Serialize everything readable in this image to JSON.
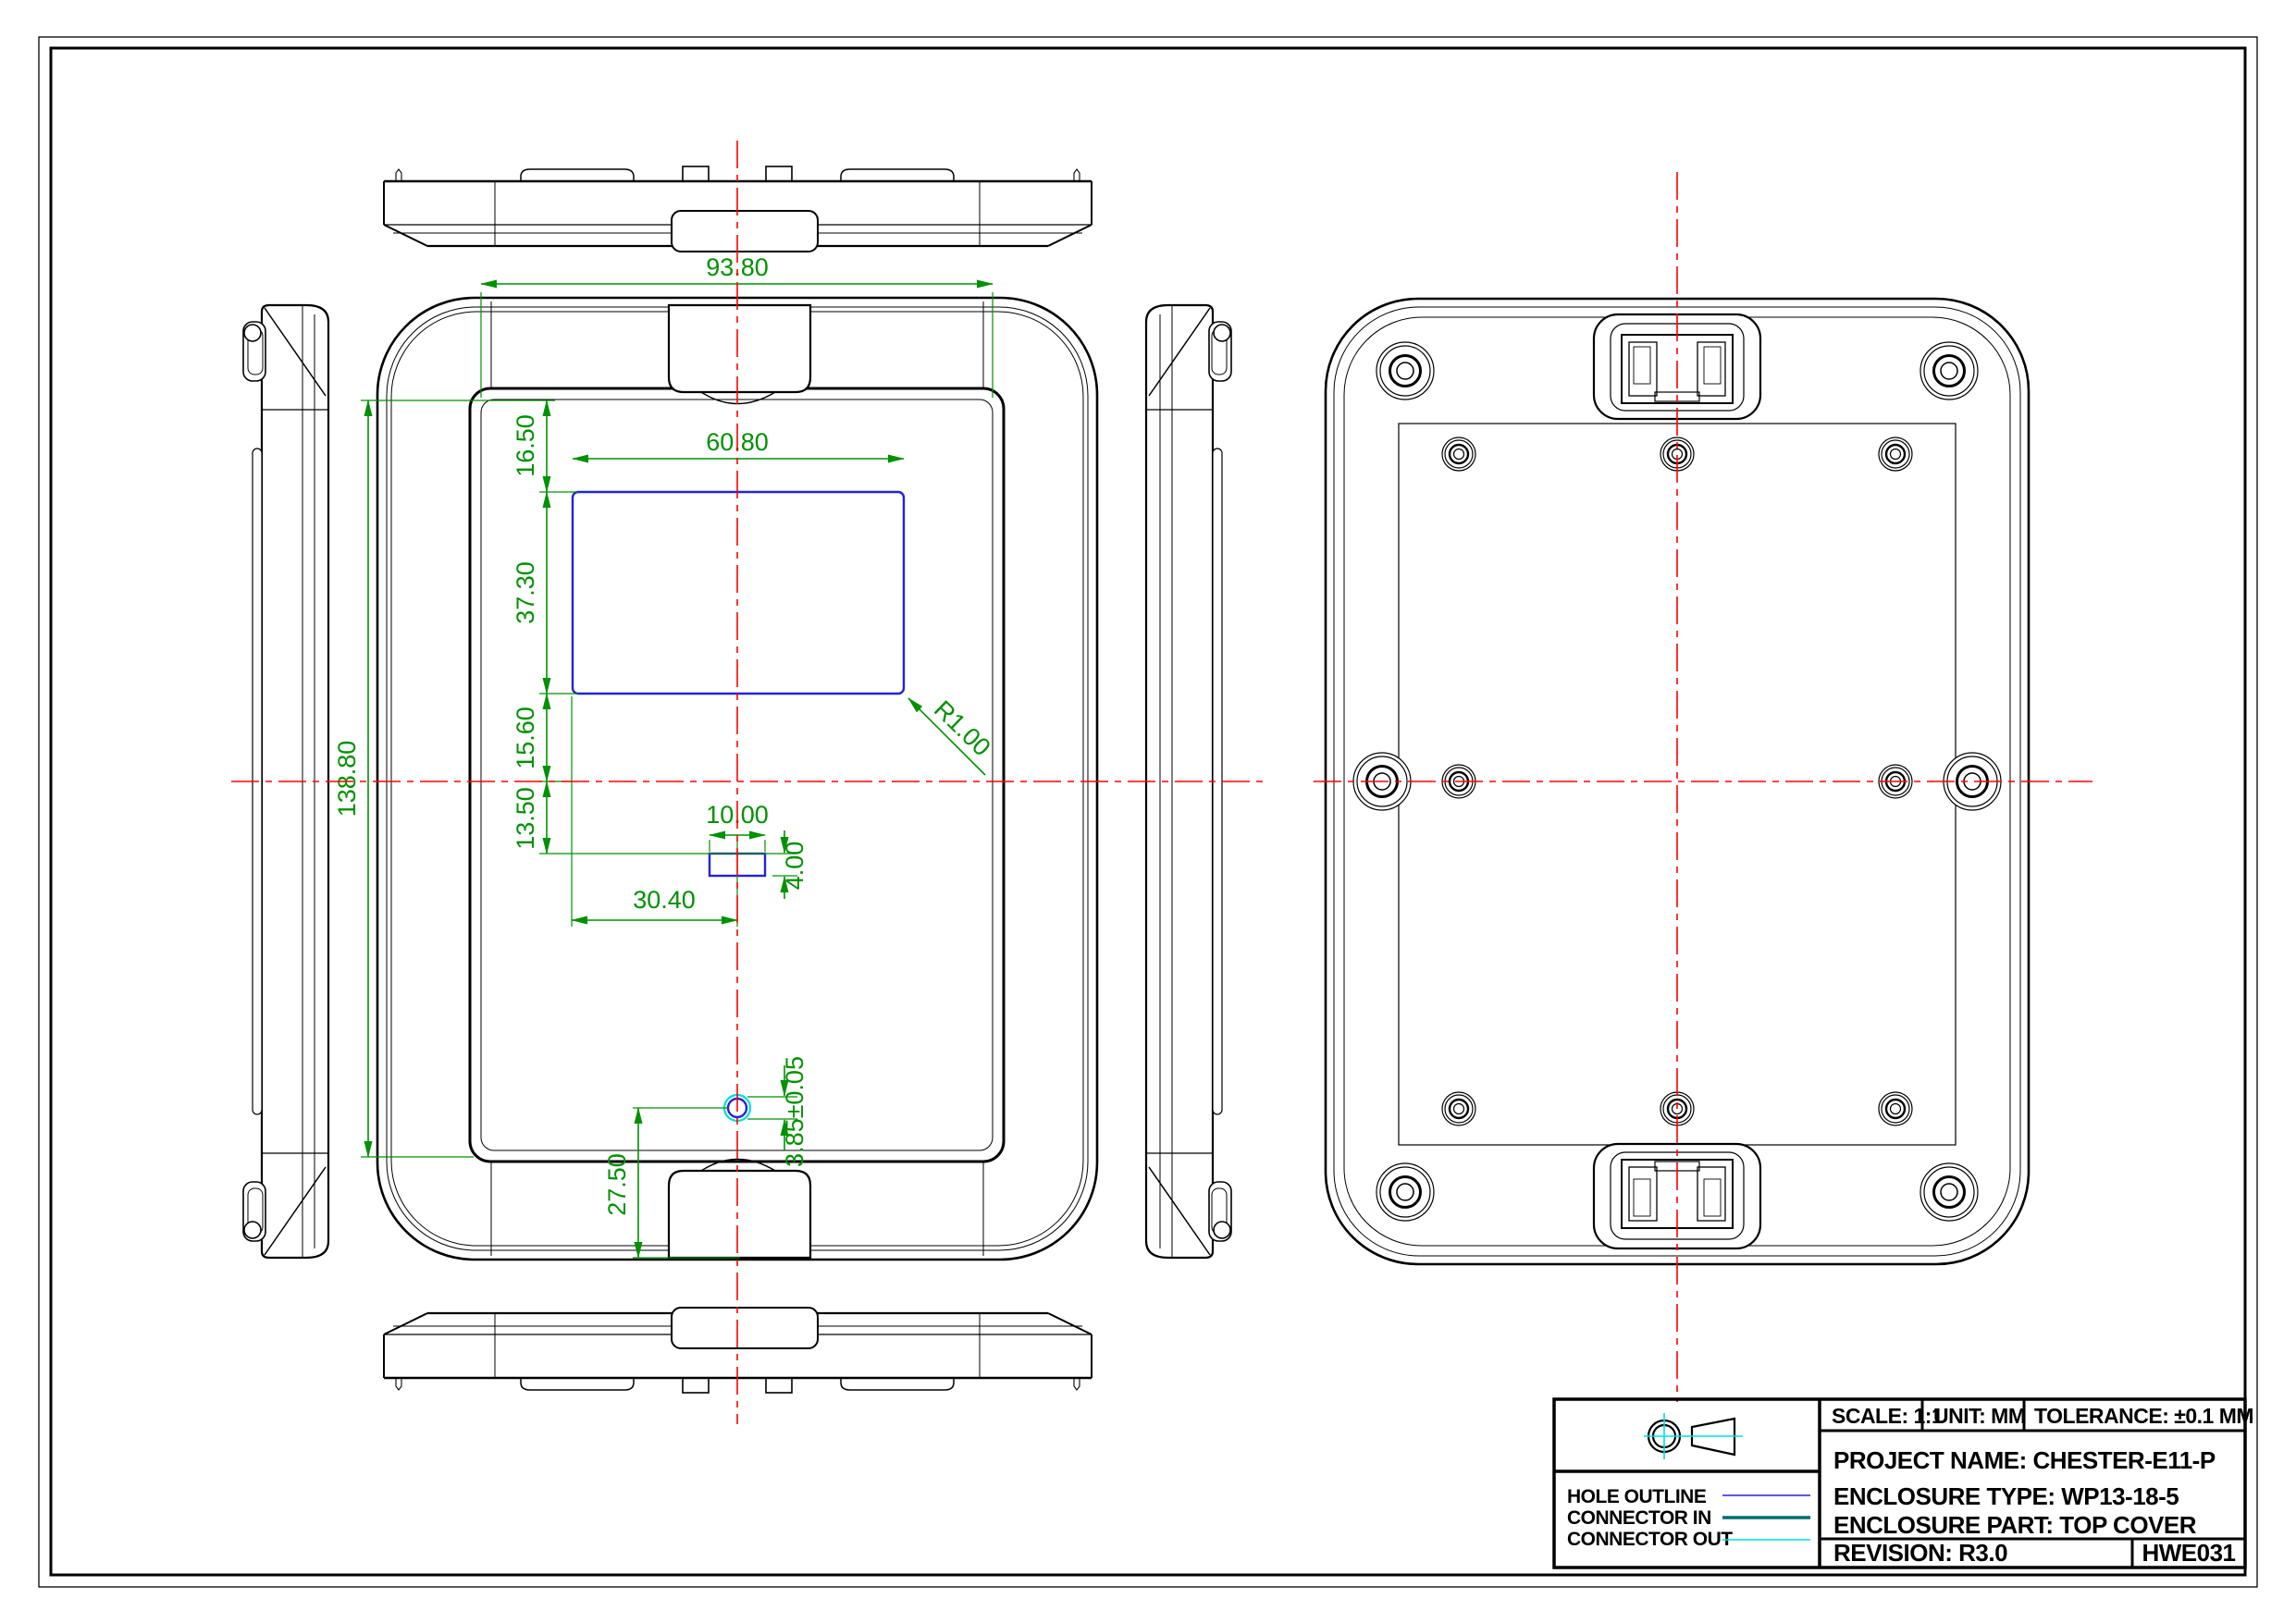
{
  "drawing": {
    "kind": "mechanical-drawing",
    "views": {
      "front": "front view (outside of top cover)",
      "back": "back view (inside of top cover)",
      "left_edge": "left side view",
      "right_edge": "right side view",
      "top_edge": "top edge view",
      "bottom_edge": "bottom edge view"
    }
  },
  "colors": {
    "outline": "#000000",
    "dimension": "#009100",
    "centerline": "#ff0000",
    "hole_outline": "#2222dd",
    "connector_in": "#006f6f",
    "connector_out": "#00dede"
  },
  "dimensions": {
    "panel_width": "93.80",
    "cutout_width": "60.80",
    "cutout_top_offset": "16.50",
    "cutout_height": "37.30",
    "cutout_to_centerline": "15.60",
    "centerline_to_slot": "13.50",
    "panel_height": "138.80",
    "slot_width": "10.00",
    "slot_height": "4.00",
    "slot_center_offset": "30.40",
    "cutout_corner_radius": "R1.00",
    "hole_diameter": "3.85±0.05",
    "hole_bottom_offset": "27.50"
  },
  "legend": {
    "items": [
      {
        "label": "HOLE OUTLINE",
        "color": "#2222dd"
      },
      {
        "label": "CONNECTOR IN",
        "color": "#006f6f"
      },
      {
        "label": "CONNECTOR OUT",
        "color": "#00dede"
      }
    ]
  },
  "title_block": {
    "scale": "SCALE: 1:1",
    "unit": "UNIT: MM",
    "tolerance": "TOLERANCE: ±0.1 MM",
    "project": "PROJECT NAME: CHESTER-E11-P",
    "type": "ENCLOSURE TYPE: WP13-18-5",
    "part": "ENCLOSURE PART: TOP COVER",
    "revision": "REVISION: R3.0",
    "code": "HWE031"
  }
}
